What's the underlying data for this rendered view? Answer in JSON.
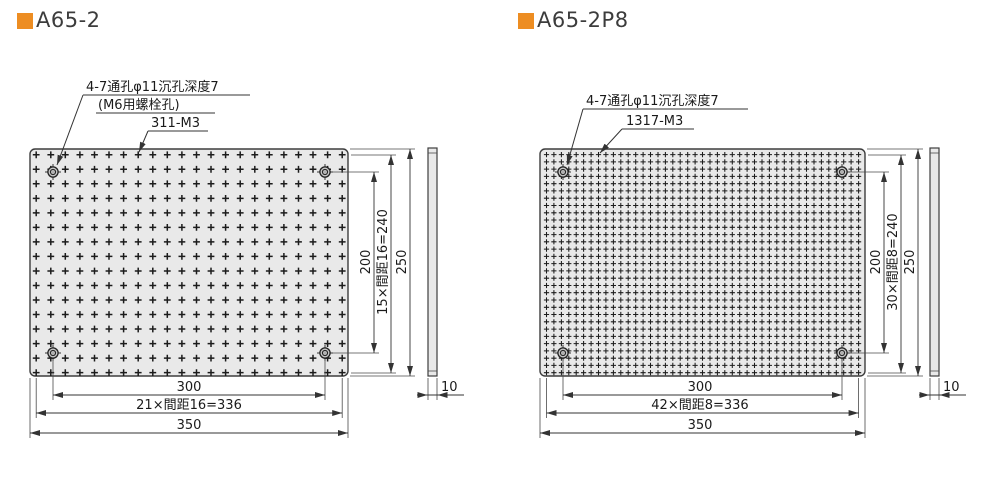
{
  "accent_color": "#ED8D22",
  "drawings": [
    {
      "title": "A65-2",
      "callouts": {
        "hole_spec": "4-7通孔φ11沉孔深度7",
        "hole_note": "(M6用螺栓孔)",
        "tap_count": "311-M3"
      },
      "dims": {
        "h_holes": "300",
        "h_span": "21×間距16=336",
        "h_outer": "350",
        "v_holes": "200",
        "v_span": "15×間距16=240",
        "v_outer": "250",
        "thickness": "10"
      },
      "grid": {
        "cols": 22,
        "rows": 16
      }
    },
    {
      "title": "A65-2P8",
      "callouts": {
        "hole_spec": "4-7通孔φ11沉孔深度7",
        "tap_count": "1317-M3"
      },
      "dims": {
        "h_holes": "300",
        "h_span": "42×間距8=336",
        "h_outer": "350",
        "v_holes": "200",
        "v_span": "30×間距8=240",
        "v_outer": "250",
        "thickness": "10"
      },
      "grid": {
        "cols": 43,
        "rows": 31
      }
    }
  ]
}
